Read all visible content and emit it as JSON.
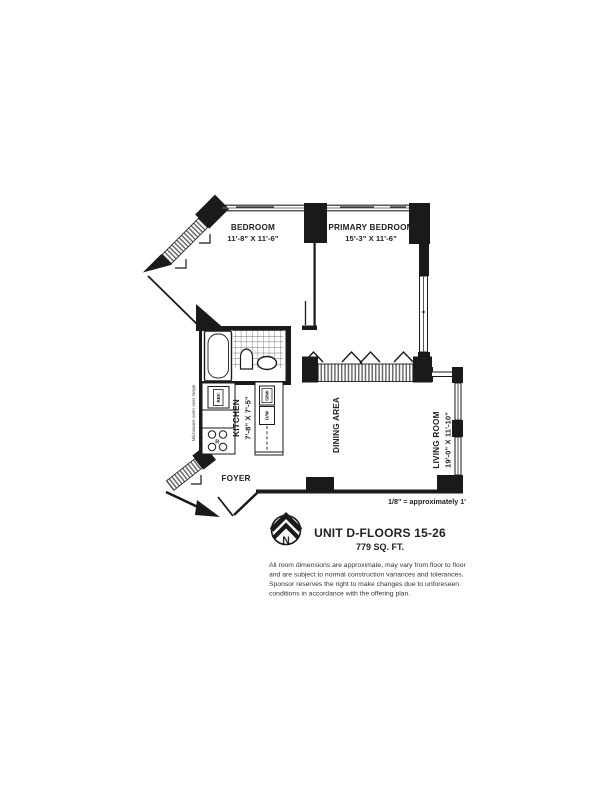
{
  "plan": {
    "rooms": {
      "bedroom": {
        "name": "BEDROOM",
        "dims": "11'-8\" X 11'-6\""
      },
      "primary_bedroom": {
        "name": "PRIMARY BEDROOM",
        "dims": "15'-3\" X 11'-6\""
      },
      "kitchen": {
        "name": "KITCHEN",
        "dims": "7'-8\" X 7'-5\""
      },
      "dining": {
        "name": "DINING AREA"
      },
      "living": {
        "name": "LIVING ROOM",
        "dims": "19'-0\" X 11'-10\""
      },
      "foyer": {
        "name": "FOYER"
      }
    },
    "appliances": {
      "ref": "REF.",
      "sink": "SINK",
      "dw": "D/W",
      "range_letter": "R",
      "range_note": "Microwave oven over range"
    },
    "compass": {
      "north": "N"
    }
  },
  "scale_note": "1/8\" = approximately 1'",
  "unit": {
    "title": "UNIT D-FLOORS 15-26",
    "area": "779 SQ. FT."
  },
  "disclaimer": {
    "lines": [
      "All room dimensions are approximate, may vary from floor to floor",
      "and are subject to normal construction variances and tolerances.",
      "Sponsor reserves the right to make changes due to unforeseen",
      "conditions in accordance with the offering plan."
    ]
  },
  "colors": {
    "ink": "#1a1a1a",
    "text": "#222222"
  }
}
